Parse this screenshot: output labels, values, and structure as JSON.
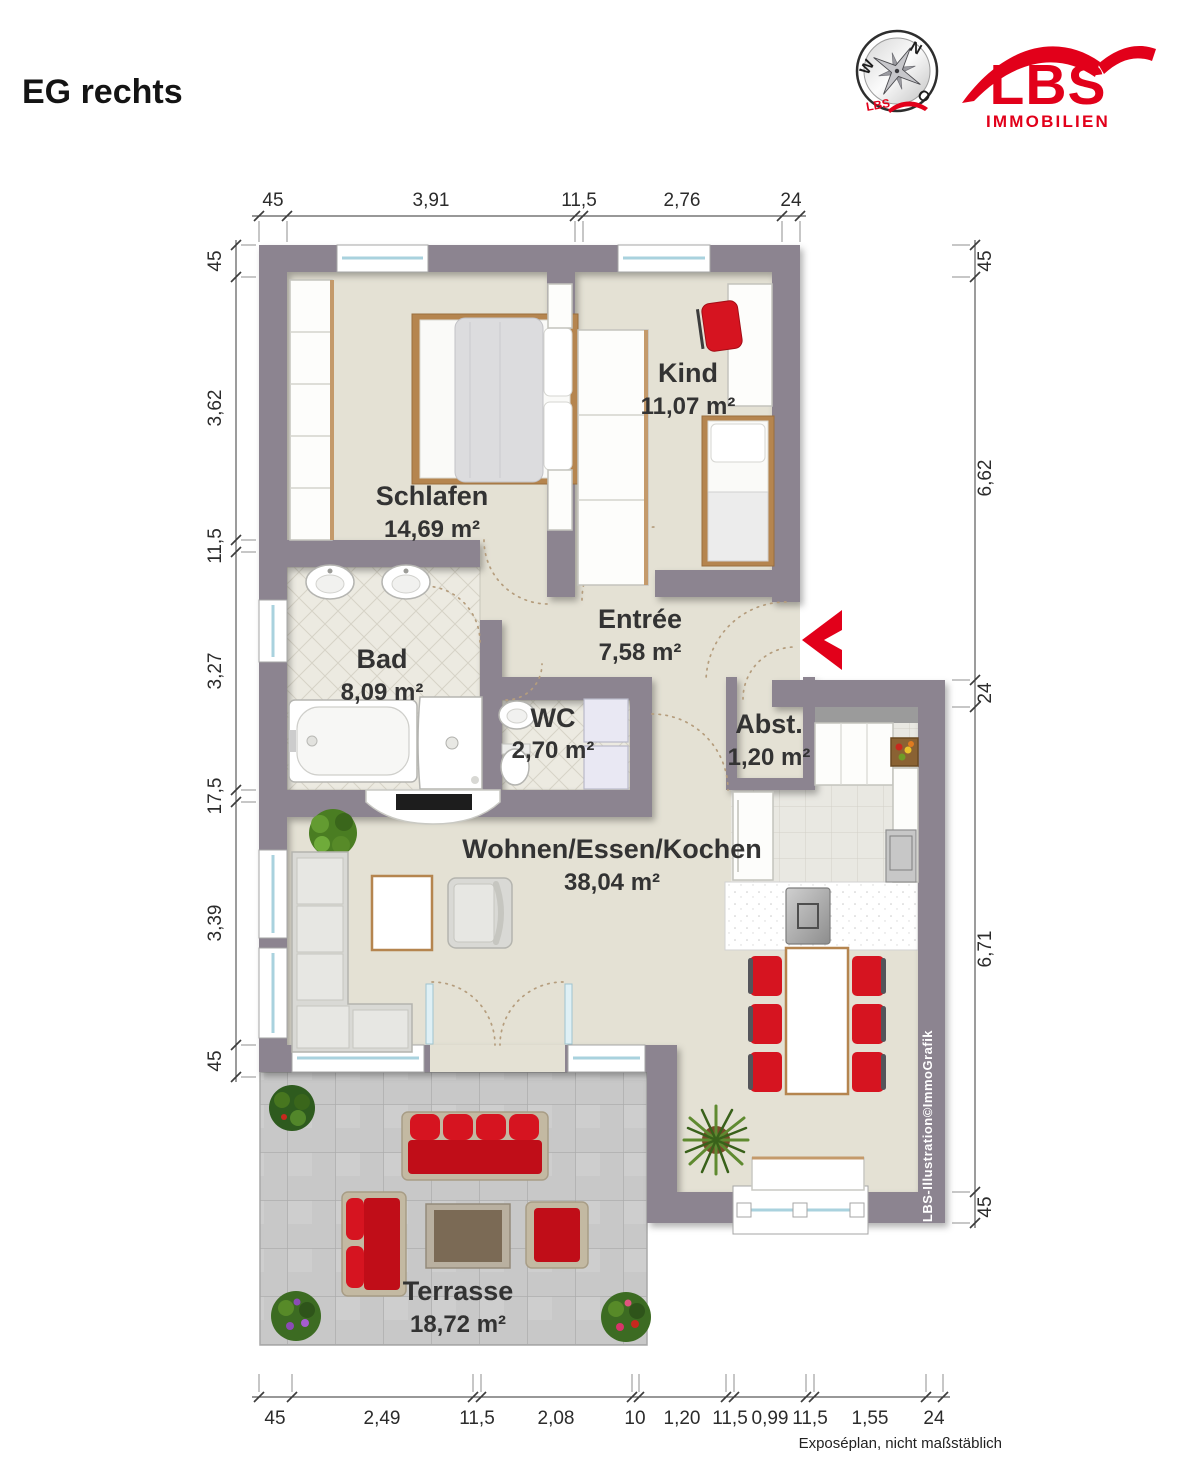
{
  "header": {
    "title": "EG rechts"
  },
  "logo": {
    "brand": "LBS",
    "subtitle": "IMMOBILIEN",
    "red": "#e2001a",
    "compass": {
      "n": "N",
      "w": "W",
      "o": "O",
      "brand": "LBS"
    }
  },
  "rooms": {
    "schlafen": {
      "name": "Schlafen",
      "area": "14,69 m²"
    },
    "kind": {
      "name": "Kind",
      "area": "11,07 m²"
    },
    "bad": {
      "name": "Bad",
      "area": "8,09 m²"
    },
    "wc": {
      "name": "WC",
      "area": "2,70 m²"
    },
    "entree": {
      "name": "Entrée",
      "area": "7,58 m²"
    },
    "abst": {
      "name": "Abst.",
      "area": "1,20 m²"
    },
    "wohnen": {
      "name": "Wohnen/Essen/Kochen",
      "area": "38,04 m²"
    },
    "terrasse": {
      "name": "Terrasse",
      "area": "18,72 m²"
    }
  },
  "dimensions": {
    "top": [
      "45",
      "3,91",
      "11,5",
      "2,76",
      "24"
    ],
    "left": [
      "45",
      "3,62",
      "11,5",
      "3,27",
      "17,5",
      "3,39",
      "45"
    ],
    "right": [
      "45",
      "6,62",
      "24",
      "6,71",
      "45"
    ],
    "bottom": [
      "45",
      "2,49",
      "11,5",
      "2,08",
      "10",
      "1,20",
      "11,5",
      "0,99",
      "11,5",
      "1,55",
      "24"
    ]
  },
  "footer": {
    "disclaimer": "Exposéplan, nicht maßstäblich",
    "credit": "LBS-Illustration©ImmoGrafik"
  }
}
